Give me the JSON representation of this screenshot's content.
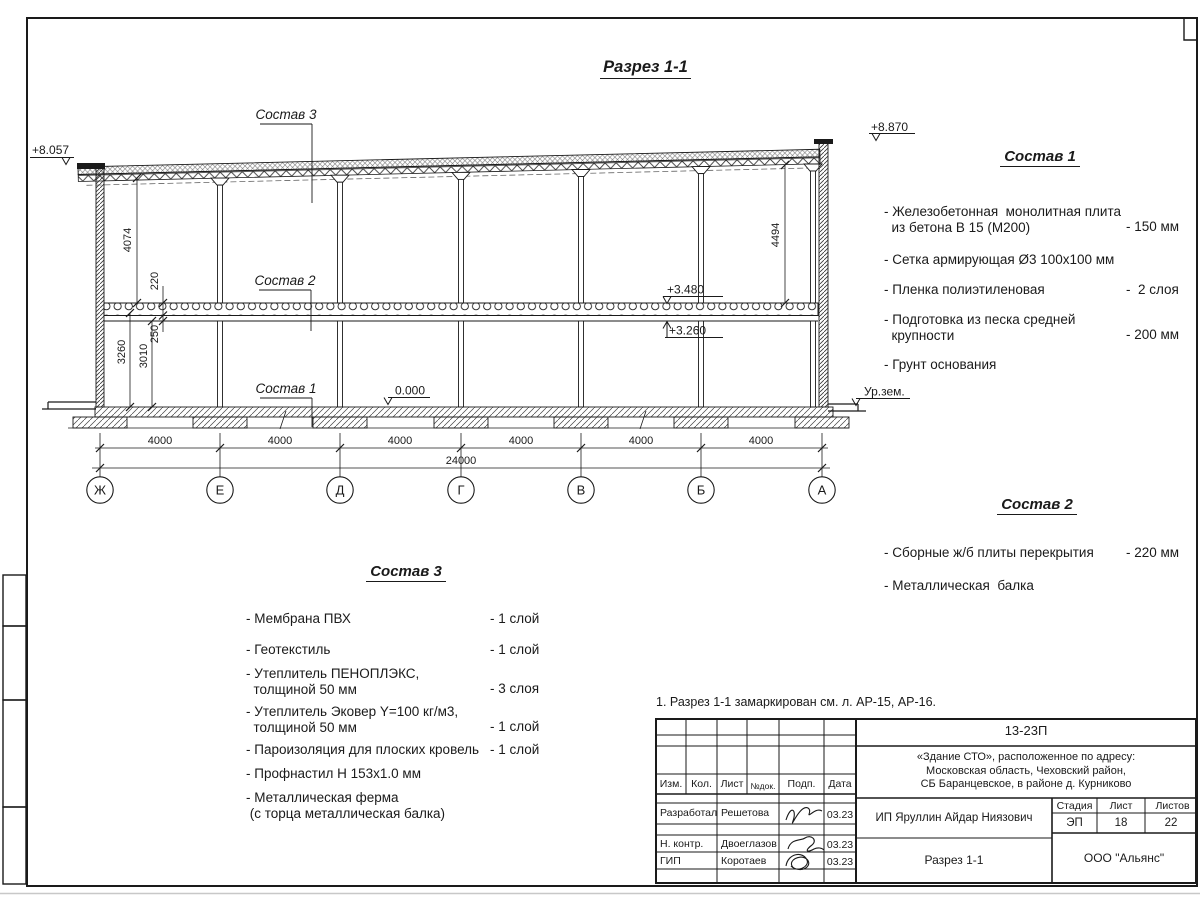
{
  "page_title": "Разрез 1-1",
  "drawing": {
    "sostav1_label": "Состав 1",
    "sostav2_label": "Состав 2",
    "sostav3_label": "Состав 3",
    "elev_left": "+8.057",
    "elev_right": "+8.870",
    "elev_slab_top": "+3.480",
    "elev_slab_bot": "+3.260",
    "elev_zero": "0.000",
    "ground_label": "Ур.зем.",
    "dim_upper_left": "4074",
    "dim_slab": "220",
    "dim_beam": "250",
    "dim_clear": "3010",
    "dim_lower": "3260",
    "dim_upper_right": "4494",
    "dim_total": "24000",
    "bays": [
      "4000",
      "4000",
      "4000",
      "4000",
      "4000",
      "4000"
    ],
    "axes": [
      "Ж",
      "Е",
      "Д",
      "Г",
      "В",
      "Б",
      "А"
    ]
  },
  "sostav1": {
    "title": "Состав 1",
    "items": [
      {
        "name": "- Железобетонная  монолитная плита\n  из бетона В 15 (М200)",
        "value": "- 150 мм"
      },
      {
        "name": "- Сетка армирующая Ø3 100х100 мм",
        "value": ""
      },
      {
        "name": "- Пленка полиэтиленовая",
        "value": "-  2 слоя"
      },
      {
        "name": "- Подготовка из песка средней\n  крупности",
        "value": "- 200 мм"
      },
      {
        "name": "- Грунт основания",
        "value": ""
      }
    ]
  },
  "sostav2": {
    "title": "Состав 2",
    "items": [
      {
        "name": "- Сборные ж/б плиты перекрытия",
        "value": "- 220 мм"
      },
      {
        "name": "- Металлическая  балка",
        "value": ""
      }
    ]
  },
  "sostav3": {
    "title": "Состав 3",
    "items": [
      {
        "name": "- Мембрана ПВХ",
        "value": "- 1 слой"
      },
      {
        "name": "- Геотекстиль",
        "value": "- 1 слой"
      },
      {
        "name": "- Утеплитель ПЕНОПЛЭКС,\n  толщиной 50 мм",
        "value": "- 3 слоя"
      },
      {
        "name": "- Утеплитель Эковер Y=100 кг/м3,\n  толщиной 50 мм",
        "value": "- 1 слой"
      },
      {
        "name": "- Пароизоляция для плоских кровель",
        "value": "- 1 слой"
      },
      {
        "name": "- Профнастил Н 153х1.0 мм",
        "value": ""
      },
      {
        "name": "- Металлическая ферма\n (с торца металлическая балка)",
        "value": ""
      }
    ]
  },
  "note": "1. Разрез 1-1 замаркирован см. л. АР-15, АР-16.",
  "titleblock": {
    "doc_number": "13-23П",
    "project": "«Здание СТО», расположенное по адресу:\nМосковская область, Чеховский район,\nСБ Баранцевское, в районе д. Курниково",
    "client": "ИП Яруллин Айдар Ниязович",
    "sheet_title": "Разрез 1-1",
    "company": "ООО \"Альянс\"",
    "headers": {
      "izm": "Изм.",
      "kol": "Кол.",
      "list": "Лист",
      "ndok": "№док.",
      "podp": "Подп.",
      "data": "Дата",
      "stadia": "Стадия",
      "list2": "Лист",
      "listov": "Листов"
    },
    "stadia_value": "ЭП",
    "list_value": "18",
    "listov_value": "22",
    "rows": [
      {
        "role": "Разработал",
        "name": "Решетова",
        "date": "03.23"
      },
      {
        "role": "Н. контр.",
        "name": "Двоеглазов",
        "date": "03.23"
      },
      {
        "role": "ГИП",
        "name": "Коротаев",
        "date": "03.23"
      }
    ]
  }
}
